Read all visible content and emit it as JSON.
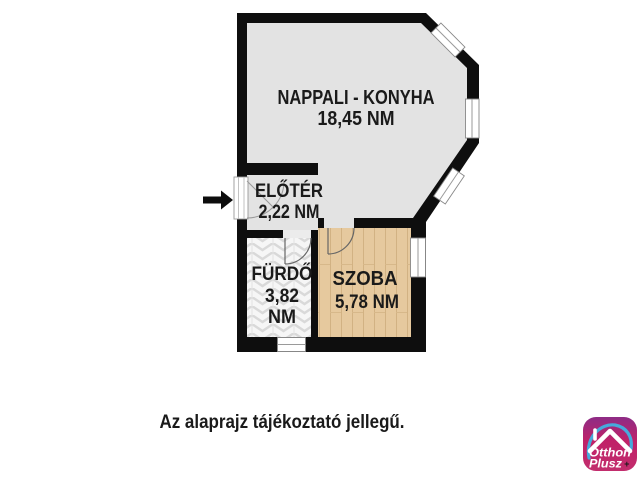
{
  "floor_plan": {
    "rooms": [
      {
        "name": "NAPPALI - KONYHA",
        "area": "18,45 NM"
      },
      {
        "name": "ELŐTÉR",
        "area": "2,22 NM"
      },
      {
        "name": "FÜRDŐ",
        "area_value": "3,82",
        "area_unit": "NM"
      },
      {
        "name": "SZOBA",
        "area": "5,78 NM"
      }
    ]
  },
  "note": "Az alaprajz tájékoztató jellegű.",
  "logo": {
    "line1": "Otthon",
    "line2": "Plusz",
    "plus": "+"
  },
  "colors": {
    "wall": "#0e0e0e",
    "floor_gray": "#e3e3e3",
    "bathroom_floor": "#f6f6f6",
    "wood_floor": "#e6c99e",
    "logo_magenta": "#c02168",
    "logo_purple": "#8e2c86",
    "logo_blue": "#46aadc",
    "logo_green": "#97c93d"
  }
}
